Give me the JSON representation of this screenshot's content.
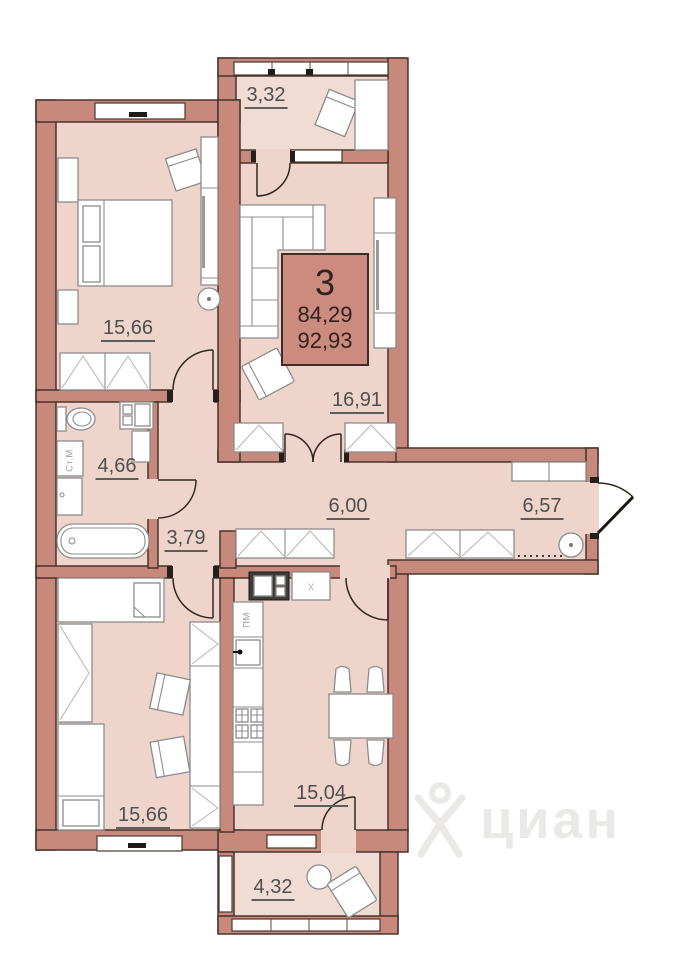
{
  "colors": {
    "wall": "#c6897b",
    "wall-line": "#3f2c25",
    "floor": "#eed4cb",
    "floor-balcony": "#f1dcd4",
    "furniture-line": "#8c8c8c",
    "badge-bg": "#cb8b7e",
    "badge-border": "#402d26",
    "label": "#4f4f4f",
    "watermark": "#ebe9e7"
  },
  "badge": {
    "flat_number": "3",
    "living_area": "84,29",
    "total_area": "92,93"
  },
  "rooms": [
    {
      "name": "balcony-top",
      "area": "3,32"
    },
    {
      "name": "bedroom",
      "area": "15,66"
    },
    {
      "name": "living-room",
      "area": "16,91"
    },
    {
      "name": "bathroom",
      "area": "4,66"
    },
    {
      "name": "hall",
      "area": "3,79"
    },
    {
      "name": "corridor",
      "area": "6,00"
    },
    {
      "name": "entrance-hall",
      "area": "6,57"
    },
    {
      "name": "kids-room",
      "area": "15,66"
    },
    {
      "name": "kitchen",
      "area": "15,04"
    },
    {
      "name": "balcony-bottom",
      "area": "4,32"
    }
  ],
  "appliances": {
    "washing_machine": "Ст.М.",
    "dishwasher": "ПМ",
    "fridge": "x"
  },
  "watermark": {
    "text": "циан"
  }
}
